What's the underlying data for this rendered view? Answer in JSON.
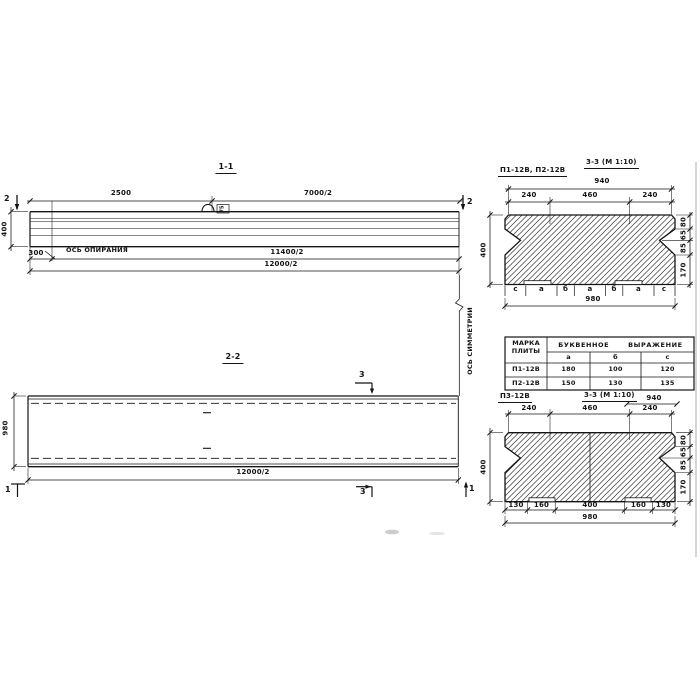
{
  "meta": {
    "ink": "#141414",
    "paper": "#ffffff"
  },
  "s11": {
    "title": "1-1",
    "dim_2500": "2500",
    "dim_7000": "7000/2",
    "dim_400": "400",
    "dim_300": "300",
    "support_axis_label": "ОСЬ ОПИРАНИЯ",
    "dim_11400": "11400/2",
    "dim_12000": "12000/2",
    "mark_left": "2",
    "mark_right": "2",
    "loop_tag": "75"
  },
  "axis": {
    "symmetry_label": "ОСЬ СИММЕТРИИ"
  },
  "s22": {
    "title": "2-2",
    "dim_980": "980",
    "dim_12000": "12000/2",
    "mark_3_top": "3",
    "mark_3_bottom": "3",
    "mark_1_left": "1",
    "mark_1_right": "1"
  },
  "s33a": {
    "label": "П1-12В, П2-12В",
    "title": "3-3 (М 1:10)",
    "dim_940": "940",
    "dims_top": [
      "240",
      "460",
      "240"
    ],
    "dim_400": "400",
    "dims_right": [
      "80",
      "65",
      "85",
      "170"
    ],
    "letters": [
      "с",
      "а",
      "б",
      "а",
      "б",
      "а",
      "с"
    ],
    "dim_980": "980"
  },
  "table": {
    "header_col1": [
      "МАРКА",
      "ПЛИТЫ"
    ],
    "header_expr": "БУКВЕННОЕ ВЫРАЖЕНИЕ",
    "cols": [
      "а",
      "б",
      "с"
    ],
    "rows": [
      [
        "П1-12В",
        "180",
        "100",
        "120"
      ],
      [
        "П2-12В",
        "150",
        "130",
        "135"
      ]
    ]
  },
  "s33b": {
    "label": "П3-12В",
    "title": "3-3 (М 1:10)",
    "dim_940": "940",
    "dims_top": [
      "240",
      "460",
      "240"
    ],
    "dim_400": "400",
    "dims_right": [
      "80",
      "65",
      "85",
      "170"
    ],
    "dims_bottom": [
      "130",
      "160",
      "400",
      "160",
      "130"
    ],
    "dim_980": "980"
  }
}
